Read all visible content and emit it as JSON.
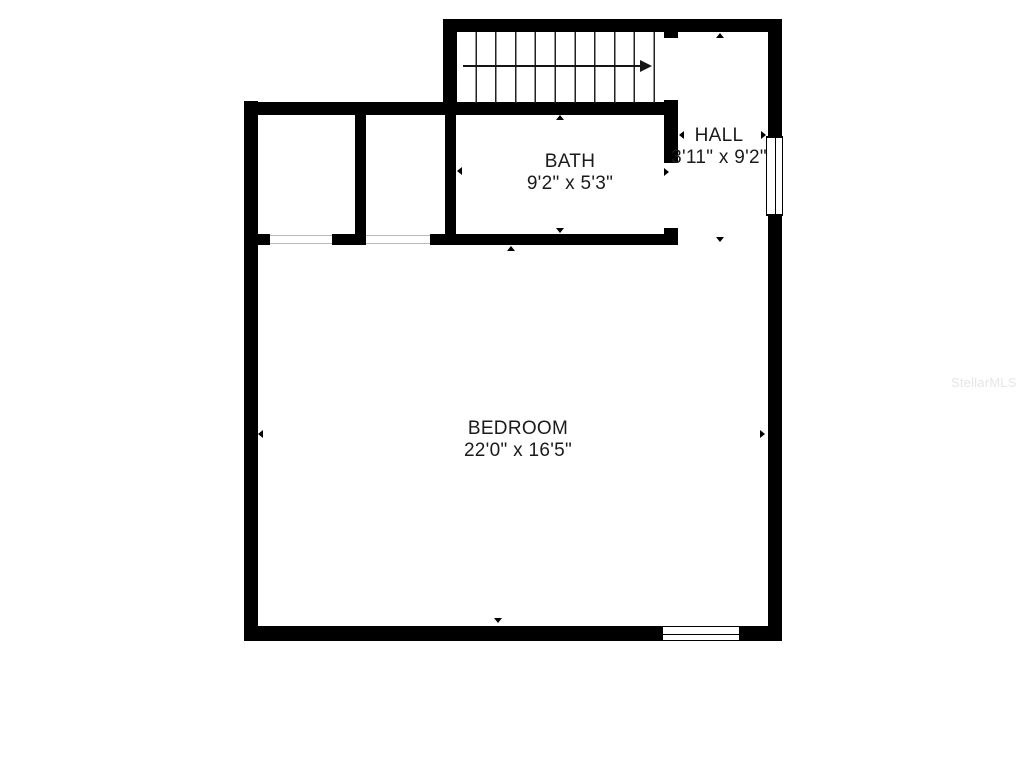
{
  "floorplan": {
    "rooms": [
      {
        "id": "bath",
        "name": "BATH",
        "dimensions": "9'2\" x 5'3\""
      },
      {
        "id": "hall",
        "name": "HALL",
        "dimensions": "3'11\" x 9'2\""
      },
      {
        "id": "bedroom",
        "name": "BEDROOM",
        "dimensions": "22'0\" x 16'5\""
      }
    ],
    "watermark": "StellarMLS",
    "colors": {
      "wall": "#000000",
      "background": "#ffffff",
      "text": "#1b1b1b",
      "watermark": "#e6e6e6"
    }
  }
}
